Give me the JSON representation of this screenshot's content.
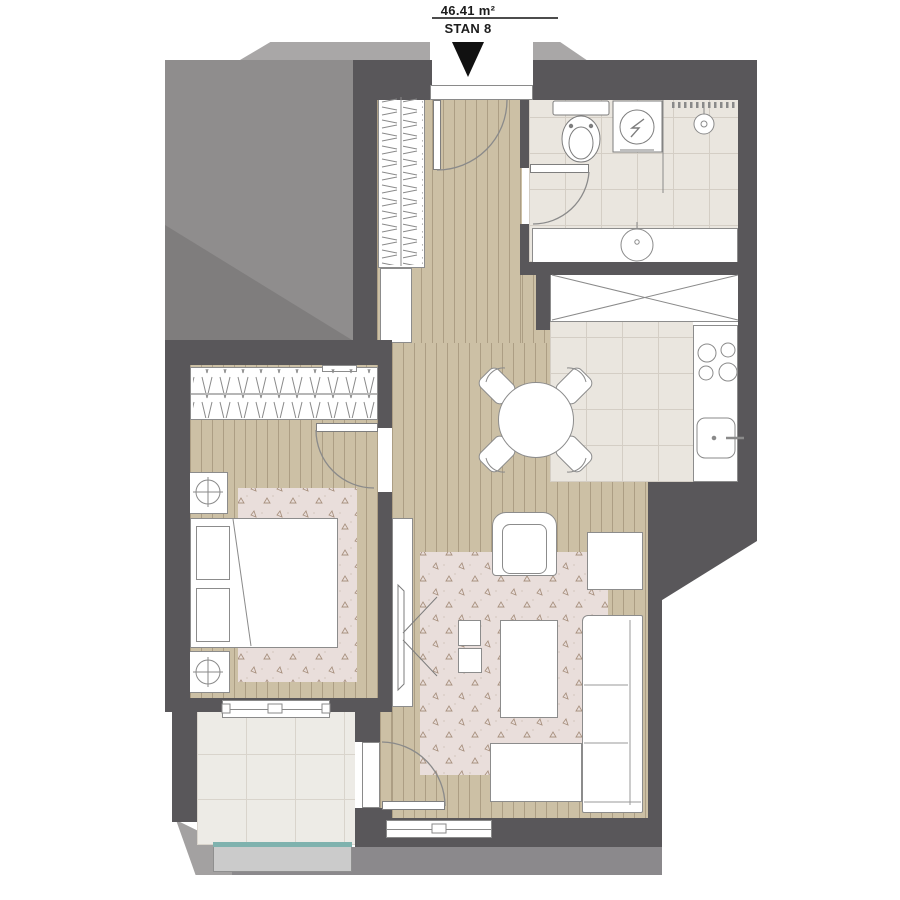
{
  "header": {
    "area": "46.41 m²",
    "unit": "STAN 8"
  },
  "plan": {
    "type": "apartment-floor-plan",
    "entrance": "top-center, door swings into hallway",
    "rooms": [
      {
        "name": "hallway",
        "floor": "wood planks",
        "furniture": [
          "closet-with-hangers",
          "cabinet"
        ]
      },
      {
        "name": "bathroom",
        "floor": "ceramic tile",
        "furniture": [
          "toilet",
          "washing-machine",
          "shower",
          "vanity-sink",
          "towel-rail"
        ]
      },
      {
        "name": "kitchen",
        "floor": "ceramic tile",
        "furniture": [
          "tall-cabinet-x",
          "hob-4-burners",
          "kitchen-sink",
          "round-dining-table",
          "four-chairs"
        ]
      },
      {
        "name": "bedroom",
        "floor": "wood planks",
        "furniture": [
          "wardrobe-with-rail",
          "double-bed",
          "nightstand-plant",
          "nightstand-plant",
          "rug"
        ]
      },
      {
        "name": "living-room",
        "floor": "wood planks",
        "furniture": [
          "tv",
          "tv-console",
          "armchair",
          "side-table",
          "coffee-table",
          "two-poufs",
          "sofa-with-chaise",
          "rug"
        ]
      },
      {
        "name": "balcony",
        "floor": "large tile",
        "furniture": [
          "glass-balustrade"
        ]
      }
    ]
  },
  "colors": {
    "wall": "#59575a",
    "shadow_mass": "#8f8d8d",
    "wood_floor": "#ccc0a5",
    "tile_floor": "#eae6df",
    "balcony_tile": "#edebe6",
    "rug": "#e9dedb",
    "glass_balustrade_accent": "#7fb2ae",
    "furniture_outline": "#8c8c8c",
    "text": "#1c1c1c"
  }
}
